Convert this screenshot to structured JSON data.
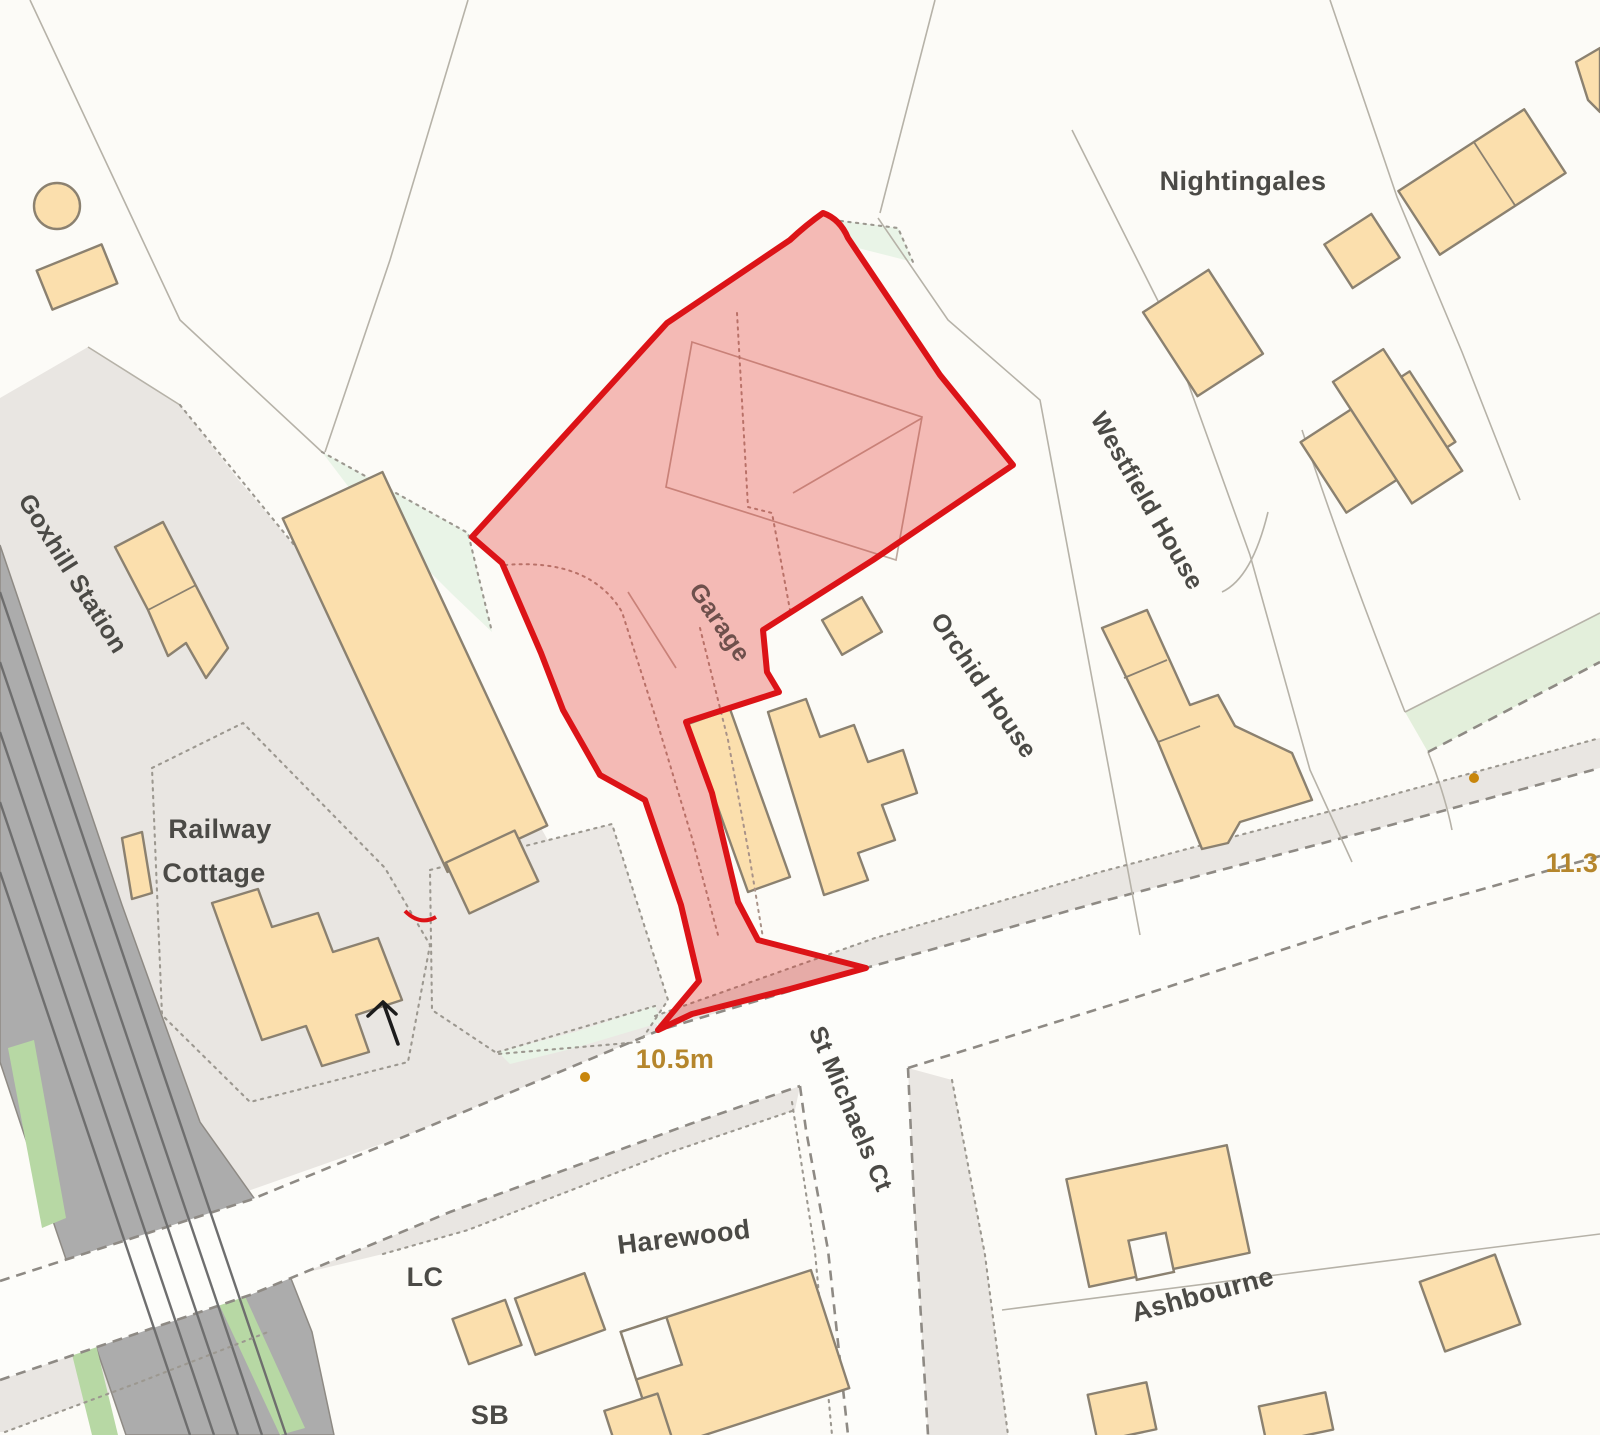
{
  "map": {
    "kind": "ordnance-survey-style site location plan",
    "labels": {
      "station": "Goxhill Station",
      "railway_cottage_line1": "Railway",
      "railway_cottage_line2": "Cottage",
      "nightingales": "Nightingales",
      "westfield_house": "Westfield House",
      "orchid_house": "Orchid House",
      "garage": "Garage",
      "st_michaels_ct": "St Michaels Ct",
      "harewood": "Harewood",
      "ashbourne": "Ashbourne",
      "lc": "LC",
      "sb": "SB",
      "spot_height_road": "10.5m",
      "spot_height_east": "11.3"
    },
    "colors": {
      "site_boundary": "#dc1317",
      "site_fill_tint": "#e2231d",
      "building_fill": "#fbdfad",
      "building_stroke": "#8b8170",
      "surface_gray": "#e9e6e2",
      "railway_gray": "#acacac",
      "railway_verge_green": "#b7d8a4",
      "open_green": "#e9f4e7",
      "spot_height_text": "#b5862c",
      "label_text": "#4b4a46",
      "background": "#fcfbf7"
    },
    "symbols": [
      "gradient-arrow-icon",
      "spot-height-dot",
      "gate-tick"
    ]
  }
}
